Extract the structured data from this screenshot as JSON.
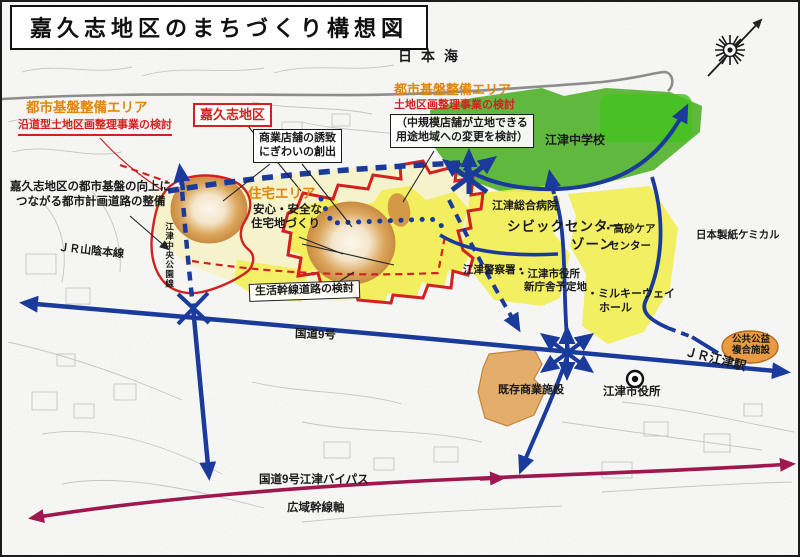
{
  "title": "嘉久志地区のまちづくり構想図",
  "colors": {
    "accent_orange": "#e0860a",
    "boundary_red": "#d42020",
    "road_blue": "#1a3a9c",
    "bypass_purple": "#a0164e",
    "zone_yellow": "#f1ee55",
    "zone_pale_yellow": "#f6f3c8",
    "zone_green": "#58b434",
    "zone_orange": "#dd9a4c"
  },
  "labels": {
    "sea": "日本海",
    "area_left_title": "都市基盤整備エリア",
    "area_left_sub": "沿道型土地区画整理事業の検討",
    "district": "嘉久志地区",
    "commercial_line1": "商業店舗の誘致",
    "commercial_line2": "にぎわいの創出",
    "area_right_title": "都市基盤整備エリア",
    "area_right_sub": "土地区画整理事業の検討",
    "midstore_line1": "（中規模店舗が立地できる",
    "midstore_line2": "用途地域への変更を検討）",
    "school": "江津中学校",
    "improve_line1": "嘉久志地区の都市基盤の向上に",
    "improve_line2": "つながる都市計画道路の整備",
    "jr_main_line": "ＪＲ山陰本線",
    "planned_road": "江津中央公園線",
    "housing_title": "住宅エリア",
    "housing_line1": "安心・安全な",
    "housing_line2": "住宅地づくり",
    "hospital": "江津総合病院",
    "civic_zone_main": "シビックセンター",
    "takasago_line1": "・高砂ケア",
    "civic_zone_main2": "ゾーン",
    "takasago_line2": "センター",
    "police": "江津警察署・",
    "new_cityhall_line1": "・江津市役所",
    "new_cityhall_line2": "新庁舎予定地",
    "milkyway_line1": "・ミルキーウェイ",
    "milkyway_line2": "ホール",
    "paper_chemical": "日本製紙ケミカル",
    "public_facility_line1": "公共公益",
    "public_facility_line2": "複合施設",
    "jr_station": "ＪＲ江津駅",
    "existing_commercial": "既存商業施設",
    "cityhall": "江津市役所",
    "route9": "国道9号",
    "life_road": "生活幹線道路の検討",
    "bypass": "国道9号江津バイパス",
    "wide_axis": "広域幹線軸"
  }
}
